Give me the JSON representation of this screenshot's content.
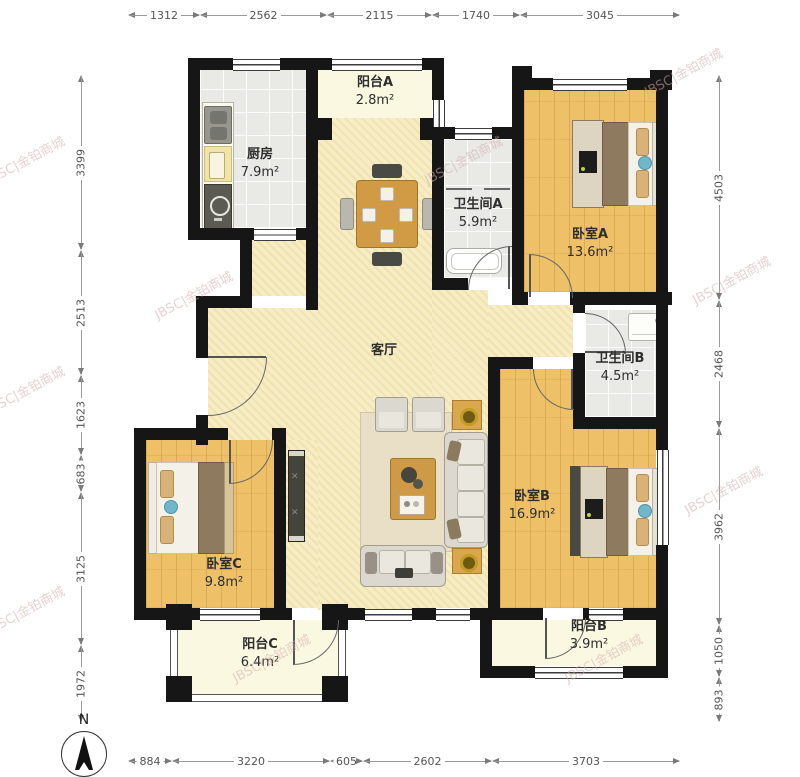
{
  "watermark": {
    "text": "JBSC|金铂商城"
  },
  "compass": {
    "label": "N"
  },
  "dimensions": {
    "top": [
      "1312",
      "2562",
      "2115",
      "1740",
      "3045"
    ],
    "left": [
      "3399",
      "2513",
      "1623",
      "683",
      "3125",
      "1972"
    ],
    "right": [
      "4503",
      "2468",
      "3962",
      "1050",
      "893"
    ],
    "bottom": [
      "884",
      "3220",
      "605",
      "2602",
      "3703"
    ]
  },
  "rooms": [
    {
      "name": "厨房",
      "area": "7.9m²"
    },
    {
      "name": "阳台A",
      "area": "2.8m²"
    },
    {
      "name": "卫生间A",
      "area": "5.9m²"
    },
    {
      "name": "卧室A",
      "area": "13.6m²"
    },
    {
      "name": "卫生间B",
      "area": "4.5m²"
    },
    {
      "name": "客厅",
      "area": ""
    },
    {
      "name": "卧室B",
      "area": "16.9m²"
    },
    {
      "name": "卧室C",
      "area": "9.8m²"
    },
    {
      "name": "阳台C",
      "area": "6.4m²"
    },
    {
      "name": "阳台B",
      "area": "3.9m²"
    }
  ],
  "colors": {
    "wall": "#161616",
    "wood": "#eec169",
    "living": "#f7edc5",
    "tile": "#e9e9e6",
    "balcony": "#fbf8e2",
    "accent_teal": "#6fb7c9",
    "gold": "#c39b25"
  }
}
